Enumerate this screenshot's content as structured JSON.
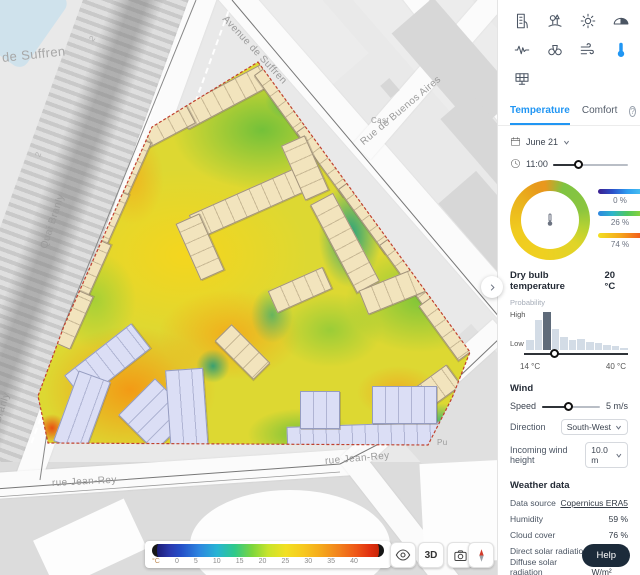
{
  "colors": {
    "accent_blue": "#2196f3",
    "link_purple": "#7b3ff2",
    "help_bg": "#1c2b3a"
  },
  "sidebar": {
    "tools": [
      "building",
      "park",
      "sun",
      "dome-shade",
      "noise",
      "binoculars",
      "wind-flow",
      "thermometer",
      "solar-panel"
    ],
    "tabs": {
      "temperature": "Temperature",
      "comfort": "Comfort"
    },
    "date": {
      "value": "June 21"
    },
    "time": {
      "value": "11:00"
    },
    "distribution": {
      "legend": [
        {
          "value": "0 %"
        },
        {
          "value": "26 %"
        },
        {
          "value": "74 %"
        }
      ]
    },
    "dry_bulb": {
      "label": "Dry bulb temperature",
      "value": "20 °C",
      "probability_label": "Probability",
      "high": "High",
      "low": "Low",
      "min": "14 °C",
      "max": "40 °C"
    },
    "wind": {
      "title": "Wind",
      "speed_label": "Speed",
      "speed_value": "5 m/s",
      "direction_label": "Direction",
      "direction_value": "South-West",
      "height_label": "Incoming wind height",
      "height_value": "10.0 m"
    },
    "weather": {
      "title": "Weather data",
      "rows": [
        {
          "label": "Data source",
          "value": "Copernicus ERA5"
        },
        {
          "label": "Humidity",
          "value": "59 %"
        },
        {
          "label": "Cloud cover",
          "value": "76 %"
        },
        {
          "label": "Direct solar radiation",
          "value": "584 W/m²"
        },
        {
          "label": "Diffuse solar radiation",
          "value": "207 W/m²"
        },
        {
          "label": "Infrared atmospheric radiation",
          "value": "379 W/m²"
        }
      ]
    },
    "help_label": "Help"
  },
  "map": {
    "labels": {
      "suffren_partial": "de Suffren",
      "avenue_suffren": "Avenue de Suffren",
      "buenos_aires": "Rue de Buenos Aires",
      "quai_branly": "Quai Branly",
      "quai_branly_partial": "ai Branly",
      "jean_rey_1": "rue Jean-Rey",
      "jean_rey_2": "rue Jean-Rey",
      "cast": "Cast",
      "pu": "Pu",
      "num_a": "2",
      "num_b": "2"
    },
    "legend": {
      "unit": "°C",
      "ticks": [
        "0",
        "5",
        "10",
        "15",
        "20",
        "25",
        "30",
        "35",
        "40"
      ]
    },
    "buttons": {
      "threed": "3D"
    }
  },
  "chart_data": [
    {
      "type": "pie",
      "title": "Temperature category share",
      "legend_position": "right",
      "segments": [
        {
          "label": "cold",
          "value": 0
        },
        {
          "label": "mild",
          "value": 26
        },
        {
          "label": "hot",
          "value": 74
        }
      ]
    },
    {
      "type": "bar",
      "title": "Dry bulb temperature probability",
      "xlabel": "Temperature",
      "ylabel": "Probability",
      "x_range_c": [
        14,
        40
      ],
      "ylabels": [
        "Low",
        "High"
      ],
      "values": [
        0.25,
        0.8,
        1.0,
        0.55,
        0.35,
        0.25,
        0.3,
        0.22,
        0.18,
        0.13,
        0.1,
        0.05
      ],
      "selected_index": 2
    }
  ]
}
